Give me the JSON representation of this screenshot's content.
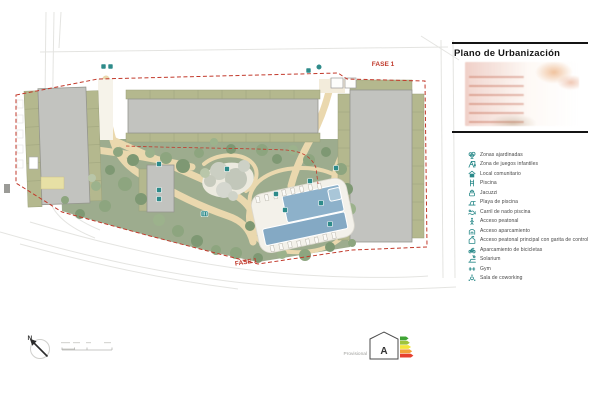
{
  "panel": {
    "title": "Plano de Urbanización",
    "legend": {
      "items": [
        {
          "label": "Zonas ajardinadas"
        },
        {
          "label": "Zona de juegos infantiles"
        },
        {
          "label": "Local comunitario"
        },
        {
          "label": "Piscina"
        },
        {
          "label": "Jacuzzi"
        },
        {
          "label": "Playa de piscina"
        },
        {
          "label": "Carril de nado piscina"
        },
        {
          "label": "Acceso peatonal"
        },
        {
          "label": "Acceso aparcamiento"
        },
        {
          "label": "Acceso peatonal principal con garita de control"
        },
        {
          "label": "Aparcamiento de bicicletas"
        },
        {
          "label": "Solarium"
        },
        {
          "label": "Gym"
        },
        {
          "label": "Sala de coworking"
        }
      ]
    }
  },
  "plan": {
    "phase_top_label": "FASE 1",
    "phase_bottom_label": "FASE 1",
    "north_label": "N"
  },
  "footer": {
    "provisional_label": "Provisional",
    "energy_rating_letter": "A"
  },
  "colors": {
    "legend_icon_teal": "#2a8a8a",
    "phase_red": "#c0392b",
    "park_green": "#9dac8e",
    "terrace_olive": "#b4b88e",
    "building_gray": "#c2c3bf",
    "path_tan": "#ead8ae",
    "pool_blue": "#8db1ca",
    "energy_arrow_colors": [
      "#3fa435",
      "#9fc43c",
      "#f4e63b",
      "#f2a23a",
      "#e6402f"
    ]
  }
}
